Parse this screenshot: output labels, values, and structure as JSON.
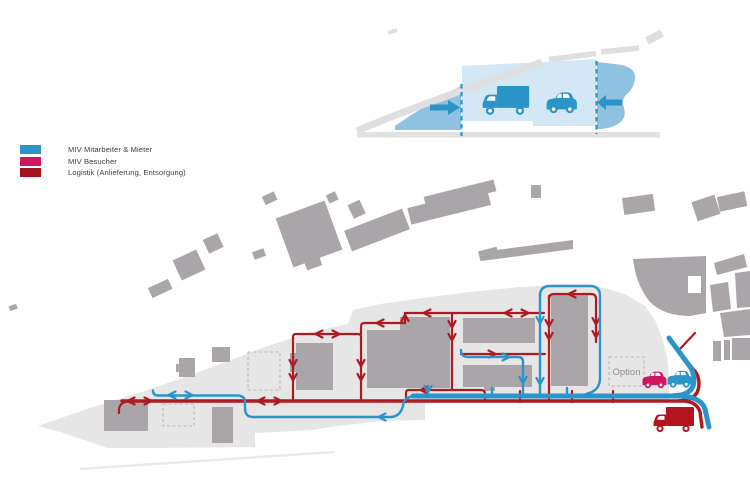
{
  "legend": {
    "items": [
      {
        "label": "MIV Mitarbeiter & Mieter",
        "color": "#2b94c9"
      },
      {
        "label": "MIV Besucher",
        "color": "#cf1760"
      },
      {
        "label": "Logistik (Anlieferung, Entsorgung)",
        "color": "#a5131f"
      }
    ]
  },
  "map": {
    "option_label": "Option"
  },
  "colors": {
    "route_blue": "#2b94c9",
    "route_red": "#ae1a22",
    "visitor_pink": "#cf1760",
    "truck_red": "#b5141f",
    "site_gray": "#e7e6e7",
    "building_gray": "#a9a5a9",
    "road_band_gray": "#dfdee0",
    "inset_blue_medium": "#8fc2e1",
    "inset_blue_light": "#d3e7f5",
    "label_gray": "#8f8c90"
  }
}
